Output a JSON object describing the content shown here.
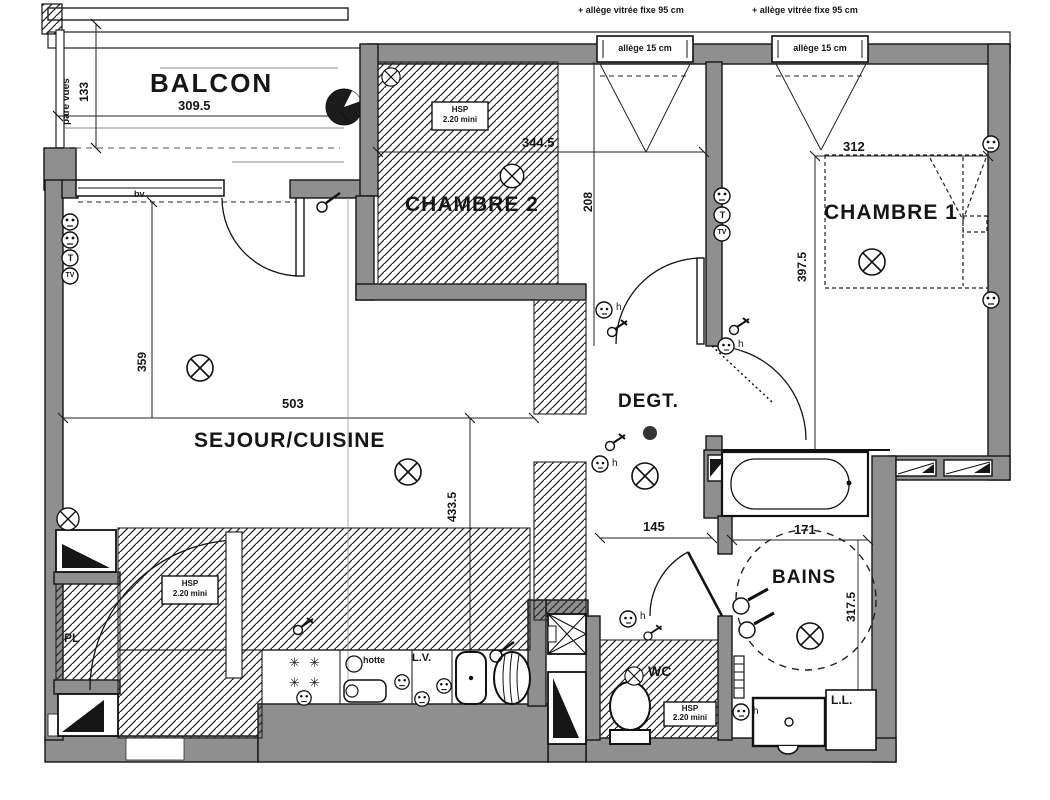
{
  "balcony": {
    "label": "BALCON",
    "width": "309.5",
    "depth": "133",
    "screen": "pare vues"
  },
  "facade": {
    "note_left": "+ allège vitrée fixe 95 cm",
    "note_right": "+ allège vitrée fixe 95 cm",
    "window_left": "allège 15 cm",
    "window_right": "allège 15 cm",
    "bay_label": "bv"
  },
  "rooms": {
    "chambre2": {
      "name": "CHAMBRE 2",
      "width": "344.5",
      "depth": "208",
      "ceiling_note": [
        "HSP",
        "2.20 mini"
      ]
    },
    "chambre1": {
      "name": "CHAMBRE 1",
      "width": "312",
      "depth": "397.5"
    },
    "sejour": {
      "name": "SEJOUR/CUISINE",
      "width": "503",
      "depth_left": "359",
      "depth_right": "433.5"
    },
    "degt": {
      "name": "DEGT.",
      "width": "145"
    },
    "bains": {
      "name": "BAINS",
      "width": "171",
      "depth": "317.5"
    },
    "wc": {
      "name": "WC",
      "ceiling_note": [
        "HSP",
        "2.20 mini"
      ]
    },
    "entry": {
      "closet": "PL",
      "ceiling_note": [
        "HSP",
        "2.20 mini"
      ]
    }
  },
  "kitchen": {
    "hood": "hotte",
    "dishwasher": "L.V."
  },
  "laundry": {
    "washer": "L.L."
  },
  "symbols": {
    "phone": "T",
    "tv": "TV",
    "wall_switch_h": "h",
    "burner": "✳"
  },
  "colors": {
    "wall": "#8f8f8f",
    "line": "#141414"
  }
}
